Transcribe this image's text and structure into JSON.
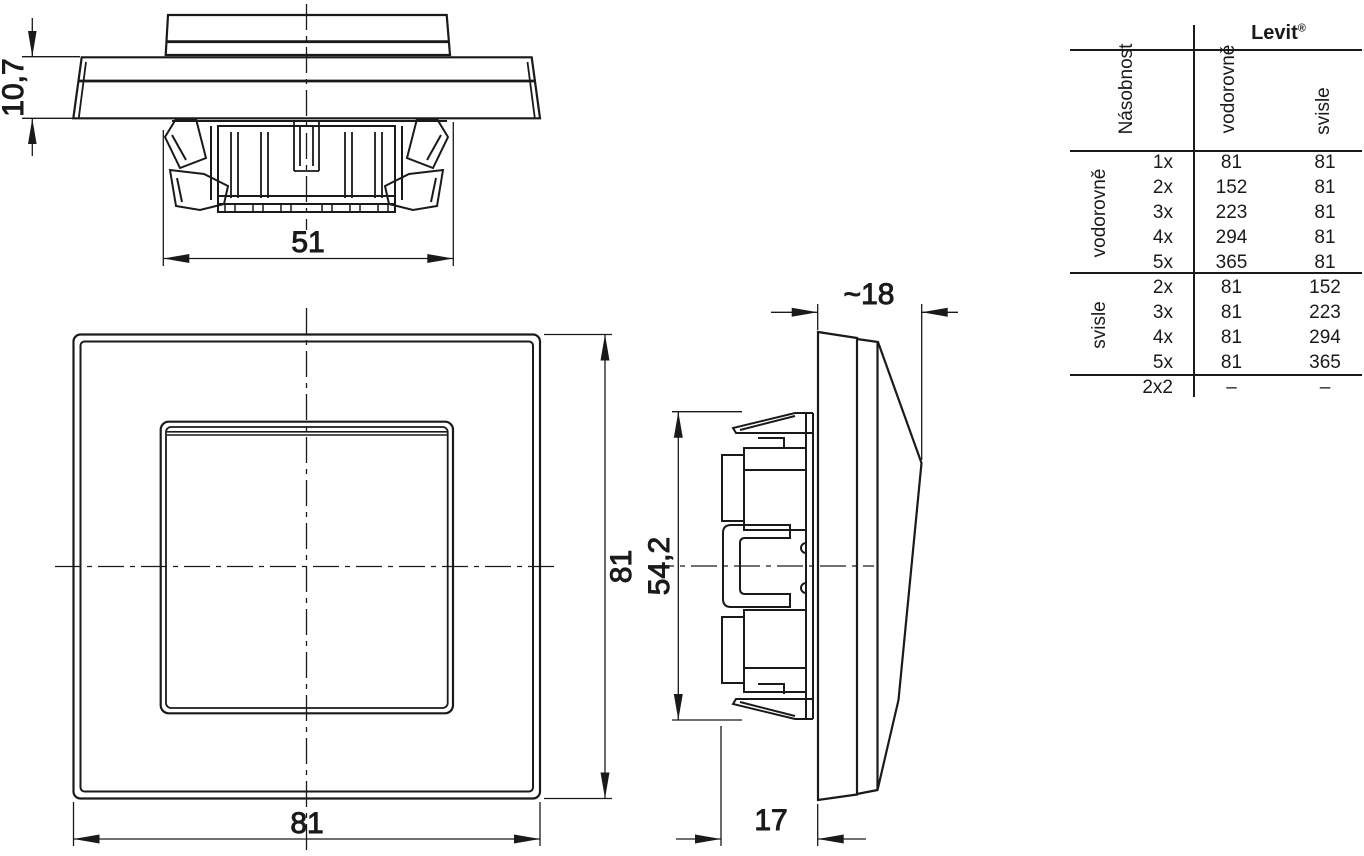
{
  "dimensions": {
    "top_view": {
      "frame_thickness": "10,7",
      "mechanism_width": "51"
    },
    "front_view": {
      "width": "81",
      "height": "81"
    },
    "side_view": {
      "total_depth": "~18",
      "mechanism_height": "54,2",
      "mechanism_depth": "17"
    }
  },
  "table": {
    "brand": "Levit",
    "brand_mark": "®",
    "headers": {
      "multiplicity": "Násobnost",
      "horizontal": "vodorovně",
      "vertical": "svisle"
    },
    "row_groups": [
      {
        "label": "vodorovně",
        "rows": [
          [
            "1x",
            "81",
            "81"
          ],
          [
            "2x",
            "152",
            "81"
          ],
          [
            "3x",
            "223",
            "81"
          ],
          [
            "4x",
            "294",
            "81"
          ],
          [
            "5x",
            "365",
            "81"
          ]
        ]
      },
      {
        "label": "svisle",
        "rows": [
          [
            "2x",
            "81",
            "152"
          ],
          [
            "3x",
            "81",
            "223"
          ],
          [
            "4x",
            "81",
            "294"
          ],
          [
            "5x",
            "81",
            "365"
          ]
        ]
      }
    ],
    "footer": [
      "2x2",
      "–",
      "–"
    ]
  },
  "colors": {
    "ink": "#1a1a1a",
    "background": "#ffffff"
  }
}
